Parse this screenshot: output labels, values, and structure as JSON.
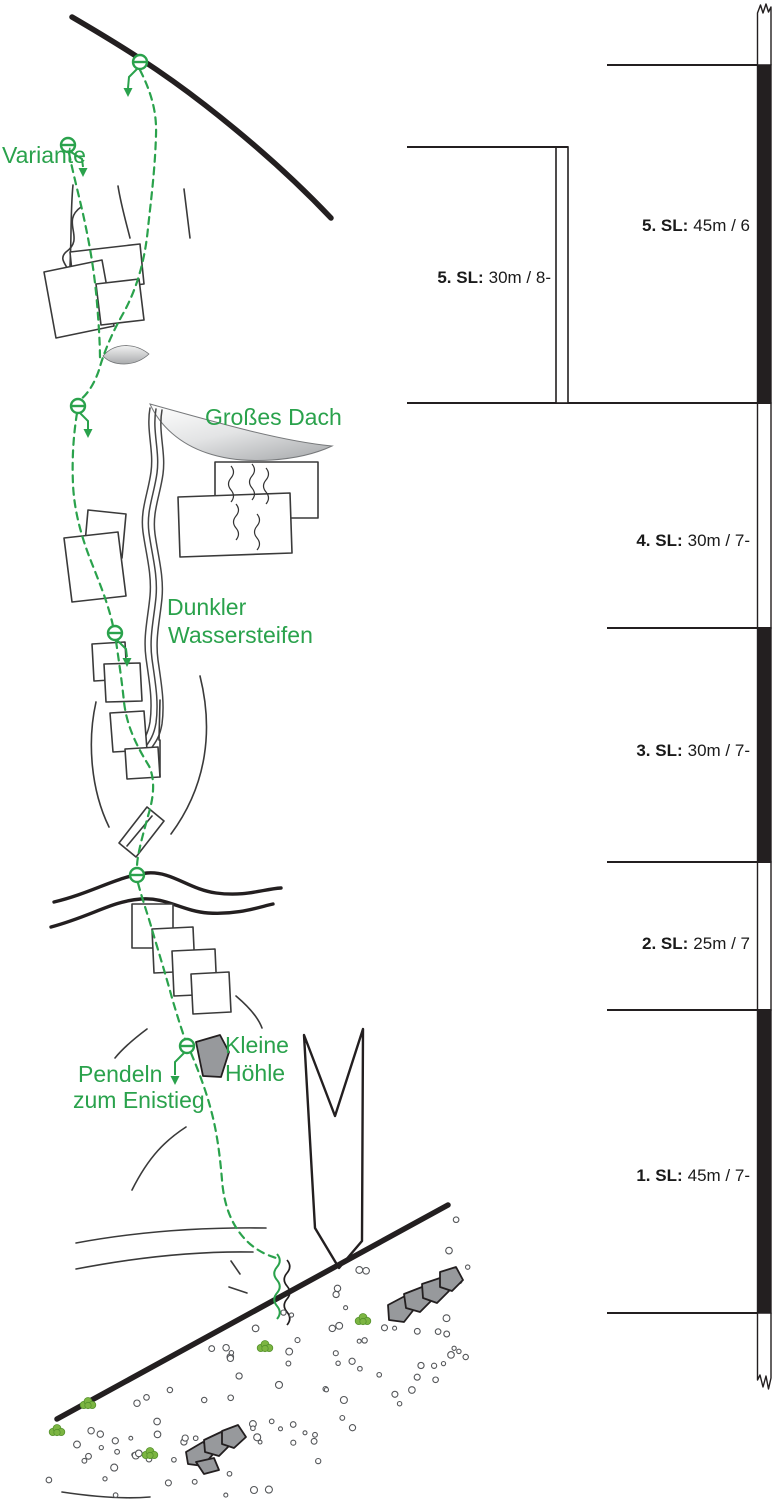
{
  "colors": {
    "route_green": "#2aa24c",
    "ink_black": "#231f20",
    "rock_gray": "#97999c",
    "roof_shade_gray": "#c6c7c9",
    "grass_green": "#7cb542"
  },
  "annotations": [
    {
      "id": "variante",
      "lines": [
        {
          "text": "Variante",
          "x": 2,
          "y": 163
        }
      ]
    },
    {
      "id": "grosses-dach",
      "lines": [
        {
          "text": "Großes Dach",
          "x": 205,
          "y": 425
        }
      ]
    },
    {
      "id": "dunkler-wassersteifen",
      "lines": [
        {
          "text": "Dunkler",
          "x": 167,
          "y": 615
        },
        {
          "text": "Wassersteifen",
          "x": 168,
          "y": 643
        }
      ]
    },
    {
      "id": "kleine-hoehle",
      "lines": [
        {
          "text": "Kleine",
          "x": 225,
          "y": 1053
        },
        {
          "text": "Höhle",
          "x": 225,
          "y": 1081
        }
      ]
    },
    {
      "id": "pendeln-zum-einstieg",
      "lines": [
        {
          "text": "Pendeln",
          "x": 78,
          "y": 1082
        },
        {
          "text": "zum Enistieg",
          "x": 73,
          "y": 1108
        }
      ]
    }
  ],
  "pitch_scale": {
    "main_bar": {
      "pitches": [
        {
          "pitch": "5. SL:",
          "info": "45m / 6",
          "length_m": 45,
          "grade": "6",
          "label_x": 750,
          "label_y": 231,
          "from": 65,
          "to": 403,
          "filled": true
        },
        {
          "pitch": "4. SL:",
          "info": "30m / 7-",
          "length_m": 30,
          "grade": "7-",
          "label_x": 750,
          "label_y": 546,
          "from": 403,
          "to": 628,
          "filled": false
        },
        {
          "pitch": "3. SL:",
          "info": "30m / 7-",
          "length_m": 30,
          "grade": "7-",
          "label_x": 750,
          "label_y": 756,
          "from": 628,
          "to": 862,
          "filled": true
        },
        {
          "pitch": "2. SL:",
          "info": "25m / 7",
          "length_m": 25,
          "grade": "7",
          "label_x": 750,
          "label_y": 949,
          "from": 862,
          "to": 1010,
          "filled": false
        },
        {
          "pitch": "1. SL:",
          "info": "45m / 7-",
          "length_m": 45,
          "grade": "7-",
          "label_x": 750,
          "label_y": 1181,
          "from": 1010,
          "to": 1313,
          "filled": true
        }
      ],
      "ticks": [
        {
          "y": 65,
          "x1": 607
        },
        {
          "y": 403,
          "x1": 407
        },
        {
          "y": 628,
          "x1": 607
        },
        {
          "y": 862,
          "x1": 607
        },
        {
          "y": 1010,
          "x1": 607
        },
        {
          "y": 1313,
          "x1": 607
        }
      ]
    },
    "variant_bar": {
      "pitch": {
        "pitch": "5. SL:",
        "info": "30m / 8-",
        "length_m": 30,
        "grade": "8-",
        "label_x": 551,
        "label_y": 283
      },
      "tick": {
        "y": 147,
        "x1": 407,
        "x2": 556
      },
      "bar": {
        "x": 556,
        "w": 12,
        "from": 147,
        "to": 403
      }
    }
  }
}
